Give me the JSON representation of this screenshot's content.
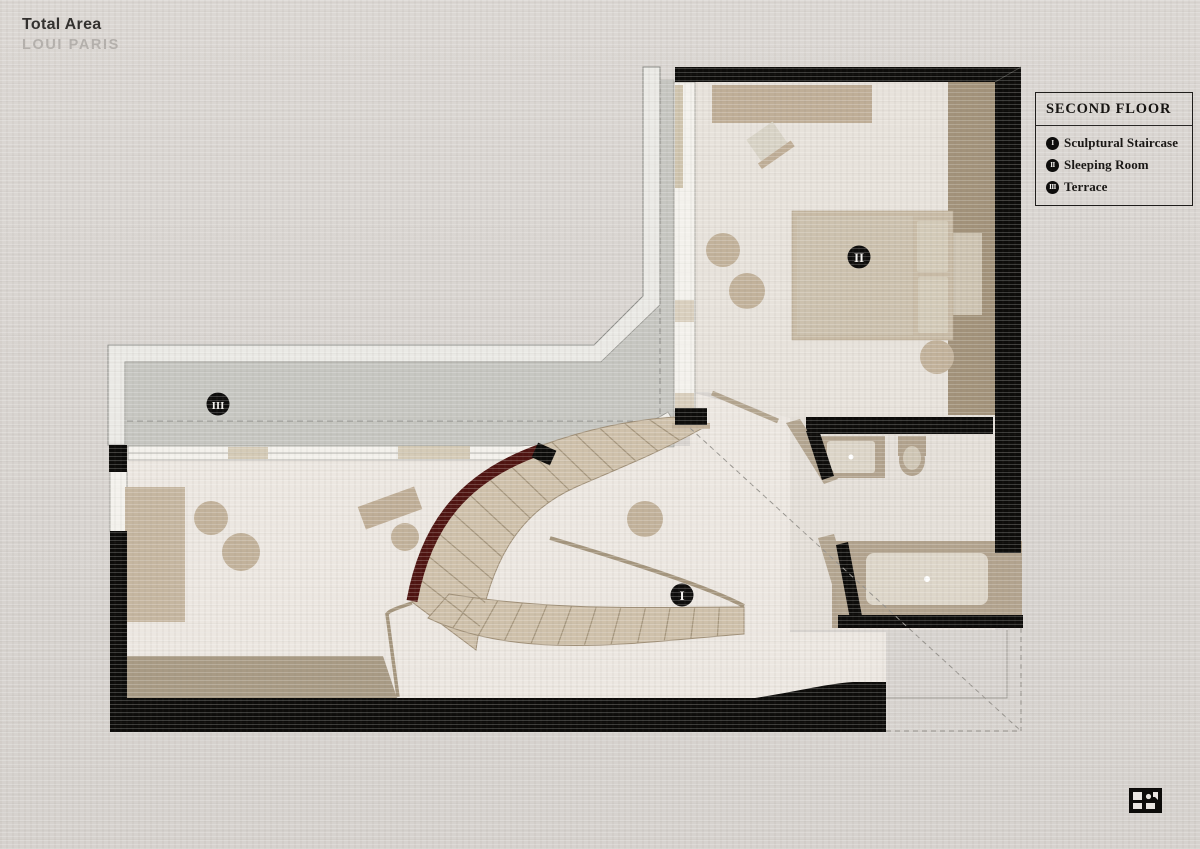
{
  "title": {
    "main": "Total Area",
    "sub": "LOUI PARIS"
  },
  "legend": {
    "title": "SECOND FLOOR",
    "items": [
      {
        "numeral": "I",
        "label": "Sculptural Staircase"
      },
      {
        "numeral": "II",
        "label": "Sleeping Room"
      },
      {
        "numeral": "III",
        "label": "Terrace"
      }
    ]
  },
  "plan": {
    "floor_name": "SECOND FLOOR",
    "markers": [
      {
        "numeral": "I",
        "room": "Sculptural Staircase"
      },
      {
        "numeral": "II",
        "room": "Sleeping Room"
      },
      {
        "numeral": "III",
        "room": "Terrace"
      }
    ]
  },
  "colors": {
    "paper": "#d9d5d1",
    "floor_light": "#ebe6e0",
    "terrace_gray": "#c6c6c1",
    "furniture_beige": "#c2b29b",
    "wall_black": "#0d0c0a",
    "stair_maroon": "#4f1411",
    "wood_tan": "#a89a84"
  }
}
